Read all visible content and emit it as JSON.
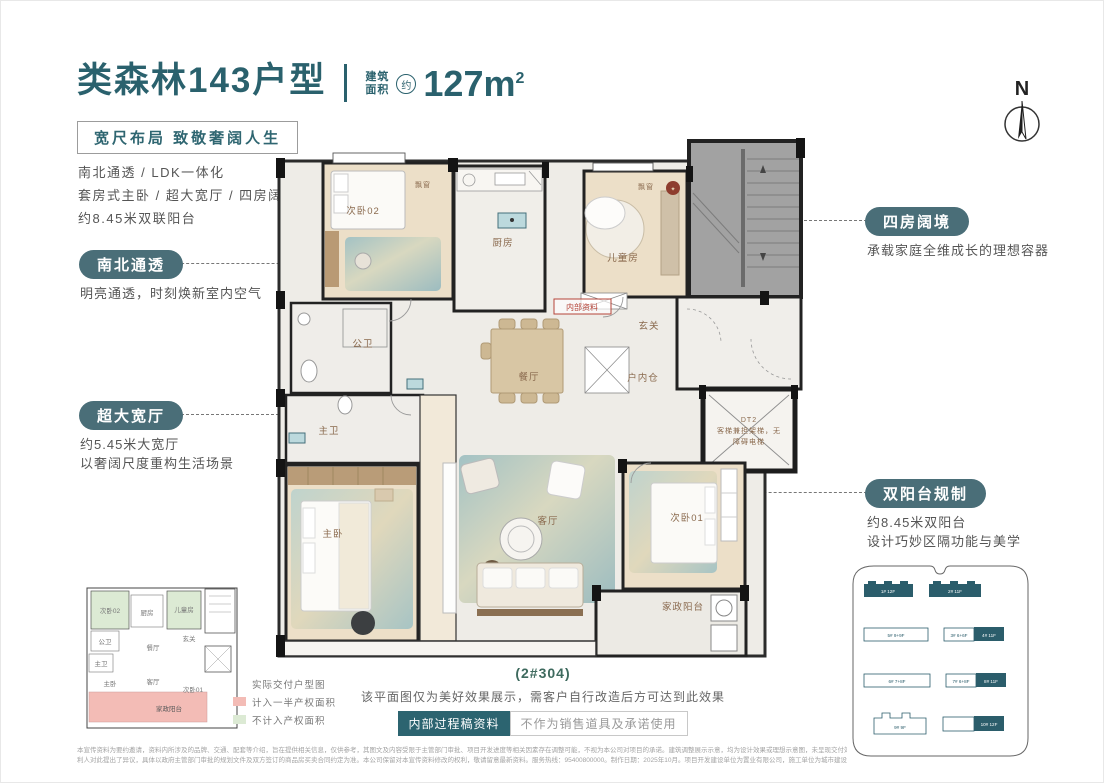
{
  "header": {
    "title": "类森林143户型",
    "area_label1": "建筑",
    "area_label2": "面积",
    "area_approx": "约",
    "area_value": "127m",
    "area_sup": "2",
    "tagline": "宽尺布局 致敬奢阔人生",
    "features": [
      "南北通透 / LDK一体化",
      "套房式主卧 / 超大宽厅 / 四房阔境",
      "约8.45米双联阳台"
    ]
  },
  "callouts": {
    "north_south": {
      "badge": "南北通透",
      "desc": "明亮通透，时刻焕新室内空气"
    },
    "wide_hall": {
      "badge": "超大宽厅",
      "desc1": "约5.45米大宽厅",
      "desc2": "以奢阔尺度重构生活场景"
    },
    "four_rooms": {
      "badge": "四房阔境",
      "desc": "承载家庭全维成长的理想容器"
    },
    "double_balcony": {
      "badge": "双阳台规制",
      "desc1": "约8.45米双阳台",
      "desc2": "设计巧妙区隔功能与美学"
    }
  },
  "compass": {
    "label": "N"
  },
  "floorplan": {
    "rooms": {
      "bedroom2": "次卧02",
      "kitchen": "厨房",
      "kids_room": "儿童房",
      "guest_bath": "公卫",
      "dining": "餐厅",
      "foyer": "玄关",
      "storage": "户内仓",
      "master_bath": "主卫",
      "master_bedroom": "主卧",
      "living": "客厅",
      "bedroom1": "次卧01",
      "service_balcony": "家政阳台",
      "bay_window_left": "飘窗",
      "bay_window_right": "飘窗"
    },
    "elevator": {
      "line1": "DT2",
      "line2": "客梯兼担架梯，无",
      "line3": "障碍电梯"
    },
    "stamp": "内部资料"
  },
  "keyplan": {
    "legend": {
      "title": "实际交付户型图",
      "half": "计入一半产权面积",
      "excluded": "不计入产权面积"
    }
  },
  "footer": {
    "unit": "(2#304)",
    "note": "该平面图仅为美好效果展示，需客户自行改造后方可达到此效果",
    "badge_internal": "内部过程稿资料",
    "badge_no_sales": "不作为销售道具及承诺使用",
    "disclaimer1": "本宣传资料为要约邀请，资料内所涉及的品牌、交通、配套等介绍，旨在提供相关信息，仅供参考，其图文及内容受限于主管部门审批、项目开发进度等相关因素存在调整可能，不视为本公司对项目的承诺。建筑调整展示示意，均为设计效果或理想示意图，未呈现交付效果，不作为交付承诺。本宣传资料部分图片及文案来源于互联网，仅作为美好示意展示，其权属归各自所有人，如权",
    "disclaimer2": "利人对此提出了异议，具体以政府主管部门审批的规划文件及双方签订的商品房买卖合同约定为准。本公司保留对本宣传资料修改的权利，敬请留意最新资料。服务热线：95400800000。制作日期：2025年10月。项目开发建设单位为置业有限公司，施工单位为城市建设有限公司，代理单位为房地产经纪有限公司。"
  },
  "siteplan": {
    "buildings": [
      {
        "text": "1# 12F",
        "filled": true
      },
      {
        "text": "2# 11F",
        "filled": true
      },
      {
        "text": "5# 9+9F",
        "filled": false
      },
      {
        "text": "3# 6+6F",
        "filled": false
      },
      {
        "text": "4# 11F",
        "filled": true
      },
      {
        "text": "6# 7+8F",
        "filled": false
      },
      {
        "text": "7# 6+8F",
        "filled": false
      },
      {
        "text": "8# 11F",
        "filled": true
      },
      {
        "text": "9# 9F",
        "filled": false
      },
      {
        "text": "10# 12F",
        "filled": true
      }
    ]
  },
  "colors": {
    "accent_teal": "#2a616d",
    "pill_teal": "#4a6e78",
    "label_brown": "#8a6a4e",
    "legend_pink": "#f3bcb6",
    "legend_green": "#dcead4",
    "site_teal": "#2b5d6b",
    "stamp_red": "#b5453a"
  }
}
